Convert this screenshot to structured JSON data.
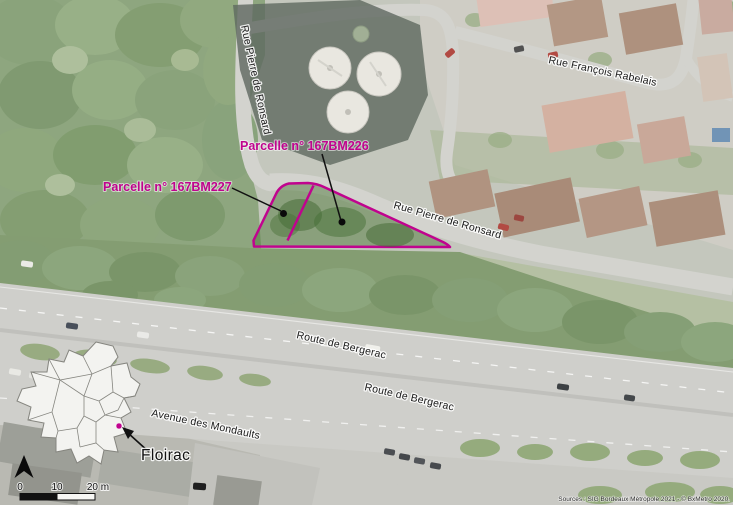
{
  "annotations": {
    "parcel_226_label": "Parcelle n° 167BM226",
    "parcel_227_label": "Parcelle n° 167BM227"
  },
  "streets": {
    "ronsard_top": "Rue Pierre de Ronsard",
    "ronsard_main": "Rue Pierre de Ronsard",
    "rabelais": "Rue François Rabelais",
    "bergerac_upper": "Route de Bergerac",
    "bergerac_lower": "Route de Bergerac",
    "mondaults": "Avenue des Mondaults"
  },
  "inset": {
    "commune_label": "Floirac"
  },
  "scale_bar": {
    "tick_0": "0",
    "tick_10": "10",
    "tick_20": "20 m"
  },
  "attribution": "Sources : SIG Bordeaux Métropole 2021 - © BxMetro 2020.",
  "colors": {
    "parcel_outline": "#c0038e",
    "street_label": "#1a1a1a"
  }
}
